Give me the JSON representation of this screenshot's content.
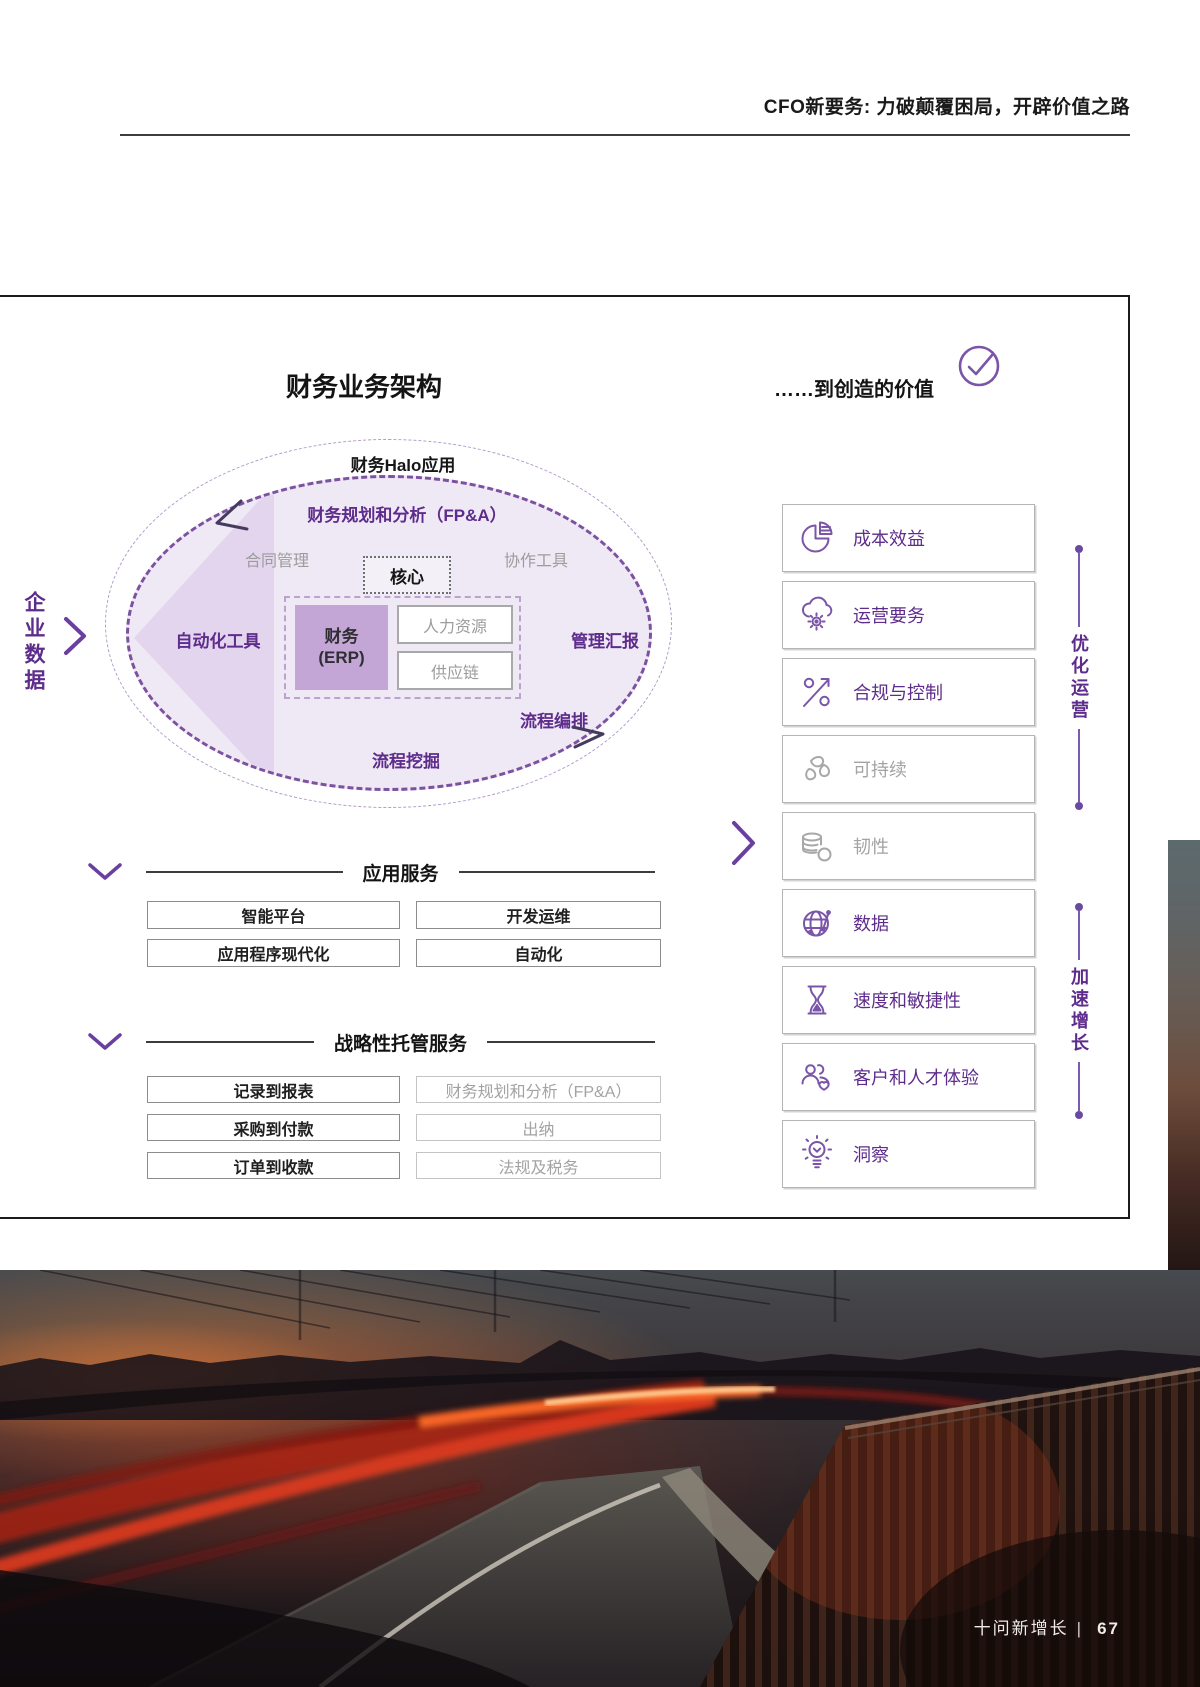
{
  "header": {
    "title": "CFO新要务: 力破颠覆困局，开辟价值之路"
  },
  "diagram": {
    "title": "财务业务架构",
    "value_title": "……到创造的价值",
    "check_icon": "check-circle-icon",
    "enterprise_data": "企业数据",
    "halo": {
      "label": "财务Halo应用",
      "fpa": "财务规划和分析（FP&A）",
      "contract": "合同管理",
      "core": "核心",
      "collab": "协作工具",
      "automation": "自动化工具",
      "reporting": "管理汇报",
      "orchestration": "流程编排",
      "mining": "流程挖掘",
      "erp_line1": "财务",
      "erp_line2": "(ERP)",
      "hr": "人力资源",
      "supply": "供应链"
    },
    "app_services": {
      "title": "应用服务",
      "items": [
        "智能平台",
        "开发运维",
        "应用程序现代化",
        "自动化"
      ]
    },
    "managed_services": {
      "title": "战略性托管服务",
      "items": [
        {
          "label": "记录到报表",
          "muted": false
        },
        {
          "label": "财务规划和分析（FP&A）",
          "muted": true
        },
        {
          "label": "采购到付款",
          "muted": false
        },
        {
          "label": "出纳",
          "muted": true
        },
        {
          "label": "订单到收款",
          "muted": false
        },
        {
          "label": "法规及税务",
          "muted": true
        }
      ]
    },
    "value_items": [
      {
        "label": "成本效益",
        "icon": "pie-chart-icon",
        "muted": false
      },
      {
        "label": "运营要务",
        "icon": "cloud-gear-icon",
        "muted": false
      },
      {
        "label": "合规与控制",
        "icon": "percent-arrow-icon",
        "muted": false
      },
      {
        "label": "可持续",
        "icon": "leaves-icon",
        "muted": true
      },
      {
        "label": "韧性",
        "icon": "database-icon",
        "muted": true
      },
      {
        "label": "数据",
        "icon": "globe-network-icon",
        "muted": false
      },
      {
        "label": "速度和敏捷性",
        "icon": "hourglass-icon",
        "muted": false
      },
      {
        "label": "客户和人才体验",
        "icon": "people-heart-icon",
        "muted": false
      },
      {
        "label": "洞察",
        "icon": "lightbulb-icon",
        "muted": false
      }
    ],
    "rails": [
      {
        "label": "优化运营"
      },
      {
        "label": "加速增长"
      }
    ],
    "colors": {
      "purple_text": "#5e2d8c",
      "icon_purple": "#7a55a8",
      "muted_gray": "#a3a3a3",
      "ellipse_fill": "#efe8f5",
      "erp_fill": "#c3a6d6"
    }
  },
  "footer": {
    "label": "十问新增长",
    "separator": "|",
    "page": "67"
  }
}
